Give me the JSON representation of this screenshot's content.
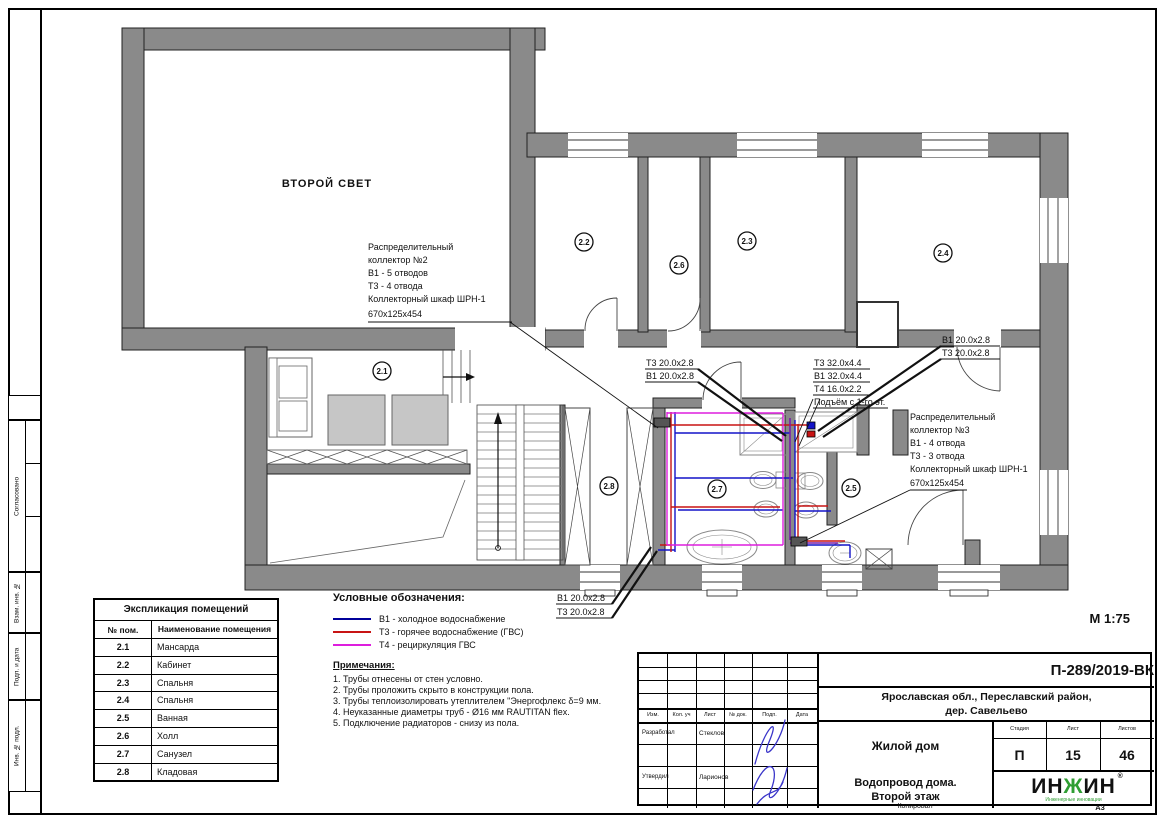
{
  "frame": {
    "stamp_side": [
      "Согласовано",
      "Взам. инв. №",
      "Подп. и дата",
      "Инв. № подл."
    ],
    "copied_label": "Копировал",
    "format_label": "А3"
  },
  "plan": {
    "second_light_label": "ВТОРОЙ СВЕТ",
    "scale_label": "М 1:75",
    "rooms": [
      {
        "num": "2.1"
      },
      {
        "num": "2.2"
      },
      {
        "num": "2.3"
      },
      {
        "num": "2.4"
      },
      {
        "num": "2.5"
      },
      {
        "num": "2.6"
      },
      {
        "num": "2.7"
      },
      {
        "num": "2.8"
      }
    ],
    "collector2": {
      "lines": [
        "Распределительный",
        "коллектор №2",
        "В1 - 5 отводов",
        "Т3 - 4 отвода",
        "Коллекторный шкаф ШРН-1",
        "670х125х454"
      ]
    },
    "collector3": {
      "lines": [
        "Распределительный",
        "коллектор №3",
        "В1 - 4 отвода",
        "Т3 - 3 отвода",
        "Коллекторный шкаф ШРН-1",
        "670х125х454"
      ]
    },
    "pipe_labels": {
      "left": [
        "Т3 20.0х2.8",
        "В1 20.0х2.8"
      ],
      "riser": [
        "Т3 32.0х4.4",
        "В1 32.0х4.4",
        "Т4 16.0х2.2",
        "Подъём с 1-го эт."
      ],
      "right": [
        "В1 20.0х2.8",
        "Т3 20.0х2.8"
      ],
      "bottom": [
        "В1 20.0х2.8",
        "Т3 20.0х2.8"
      ]
    }
  },
  "legend": {
    "title": "Условные обозначения:",
    "items": [
      {
        "label": "В1 - холодное водоснабжение",
        "color": "#00009a"
      },
      {
        "label": "Т3 - горячее водоснабжение (ГВС)",
        "color": "#c81414"
      },
      {
        "label": "Т4 - рециркуляция ГВС",
        "color": "#dd1edd"
      }
    ],
    "notes_title": "Примечания:",
    "notes": [
      "1.   Трубы отнесены от стен условно.",
      "2.   Трубы проложить скрыто в конструкции пола.",
      "3.   Трубы теплоизолировать утеплителем \"Энергофлекс δ=9 мм.",
      "4.   Неуказанные диаметры труб - Ø16 мм RAUTITAN flex.",
      "5.   Подключение радиаторов - снизу из пола."
    ]
  },
  "room_table": {
    "title": "Экспликация помещений",
    "col1": "№ пом.",
    "col2": "Наименование помещения",
    "rows": [
      [
        "2.1",
        "Мансарда"
      ],
      [
        "2.2",
        "Кабинет"
      ],
      [
        "2.3",
        "Спальня"
      ],
      [
        "2.4",
        "Спальня"
      ],
      [
        "2.5",
        "Ванная"
      ],
      [
        "2.6",
        "Холл"
      ],
      [
        "2.7",
        "Санузел"
      ],
      [
        "2.8",
        "Кладовая"
      ]
    ]
  },
  "title_block": {
    "doc_number": "П-289/2019-ВК",
    "location_line1": "Ярославская обл., Переславский район,",
    "location_line2": "дер. Савельево",
    "project": "Жилой дом",
    "sheet_title_line1": "Водопровод дома.",
    "sheet_title_line2": "Второй этаж",
    "stage_label": "Стадия",
    "stage": "П",
    "sheet_label": "Лист",
    "sheet": "15",
    "sheets_label": "Листов",
    "sheets": "46",
    "header_cols": [
      "Изм.",
      "Кол. уч",
      "Лист",
      "№ док.",
      "Подп.",
      "Дата"
    ],
    "developed_label": "Разработал",
    "developed_name": "Стеклов",
    "approved_label": "Утвердил",
    "approved_name": "Ларионов",
    "logo": {
      "part1": "ИН",
      "part2": "Ж",
      "part3": "ИН",
      "reg": "®",
      "subtitle": "Инженерные инновации",
      "green": "#2f9e33"
    }
  },
  "colors": {
    "wall_gray": "#8a8a8a",
    "pipe_b1": "#1414c8",
    "pipe_t3": "#c81414",
    "pipe_t4": "#dd1edd",
    "pipe_overlap": "#7a1fa8",
    "signature_ink": "#3a35c9"
  }
}
